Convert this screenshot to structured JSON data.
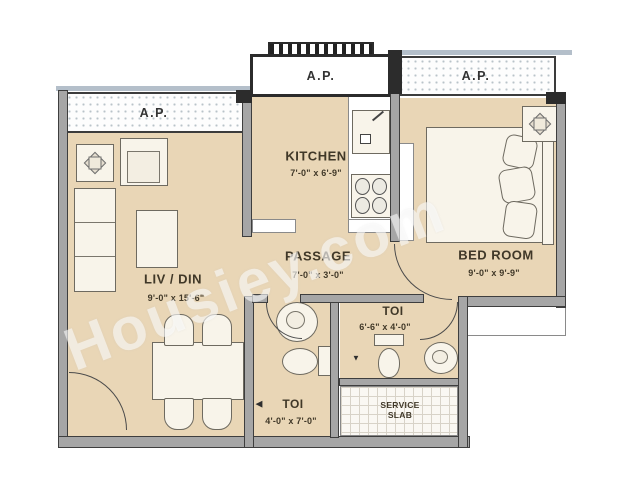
{
  "watermark": "Housiey.com",
  "balconies": {
    "left": "A.P.",
    "middle": "A.P.",
    "right": "A.P."
  },
  "rooms": {
    "living": {
      "name": "LIV / DIN",
      "dims": "9'-0\" x 15'-6\""
    },
    "kitchen": {
      "name": "KITCHEN",
      "dims": "7'-0\" x 6'-9\""
    },
    "passage": {
      "name": "PASSAGE",
      "dims": "7'-0\" x 3'-0\""
    },
    "bedroom": {
      "name": "BED ROOM",
      "dims": "9'-0\" x 9'-9\""
    },
    "toilet_right": {
      "name": "TOI",
      "dims": "6'-6\" x 4'-0\""
    },
    "toilet_bottom": {
      "name": "TOI",
      "dims": "4'-0\" x 7'-0\""
    },
    "service_slab": {
      "line1": "SERVICE",
      "line2": "SLAB"
    }
  },
  "markers": {
    "toilet_bottom_pointer": "◀",
    "toilet_right_drain": "▼"
  },
  "colors": {
    "floor": "#e9d6b6",
    "wall": "#a6a6a6",
    "wall_dark": "#2c2c2c",
    "balcony_rail": "#b4bfca",
    "label": "#403828"
  }
}
